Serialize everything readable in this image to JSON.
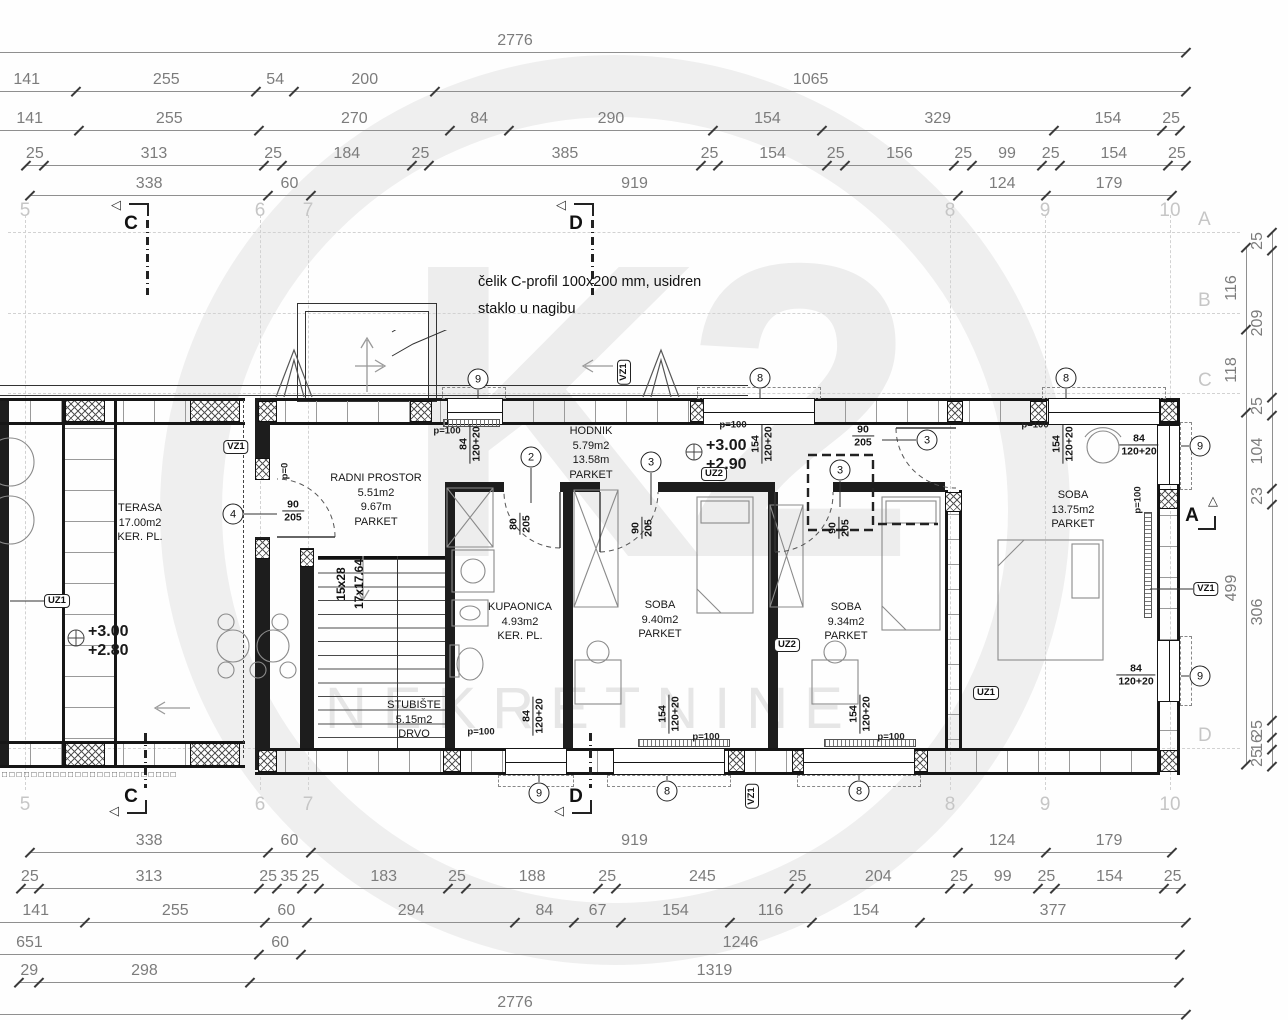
{
  "watermark": {
    "brand": "K2",
    "text": "NEKRETNINE"
  },
  "annotations": {
    "note1": "čelik C-profil 100x200 mm, usidren",
    "note2": "staklo u nagibu"
  },
  "stairs": {
    "label1": "15x28",
    "label2": "17x17.64"
  },
  "levels": [
    {
      "lines": [
        "+3.00",
        "+2.90"
      ]
    },
    {
      "lines": [
        "+3.00",
        "+2.80"
      ]
    }
  ],
  "rooms": [
    {
      "lines": [
        "TERASA",
        "17.00m2",
        "KER. PL."
      ],
      "x": 140,
      "y": 523
    },
    {
      "lines": [
        "RADNI PROSTOR",
        "5.51m2",
        "9.67m",
        "PARKET"
      ],
      "x": 376,
      "y": 500
    },
    {
      "lines": [
        "HODNIK",
        "5.79m2",
        "13.58m",
        "PARKET"
      ],
      "x": 591,
      "y": 453
    },
    {
      "lines": [
        "KUPAONICA",
        "4.93m2",
        "KER. PL."
      ],
      "x": 520,
      "y": 622
    },
    {
      "lines": [
        "SOBA",
        "9.40m2",
        "PARKET"
      ],
      "x": 660,
      "y": 620
    },
    {
      "lines": [
        "SOBA",
        "9.34m2",
        "PARKET"
      ],
      "x": 846,
      "y": 622
    },
    {
      "lines": [
        "SOBA",
        "13.75m2",
        "PARKET"
      ],
      "x": 1073,
      "y": 510
    },
    {
      "lines": [
        "STUBIŠTE",
        "5.15m2",
        "DRVO"
      ],
      "x": 414,
      "y": 720
    }
  ],
  "grid": {
    "cols": [
      {
        "n": "5",
        "x": 25
      },
      {
        "n": "6",
        "x": 260
      },
      {
        "n": "7",
        "x": 308
      },
      {
        "n": "8",
        "x": 950
      },
      {
        "n": "9",
        "x": 1045
      },
      {
        "n": "10",
        "x": 1170
      }
    ],
    "rows": [
      {
        "n": "A",
        "y": 232
      },
      {
        "n": "B",
        "y": 313
      },
      {
        "n": "C",
        "y": 393
      },
      {
        "n": "D",
        "y": 748
      }
    ]
  },
  "sections": {
    "top": [
      {
        "n": "C",
        "x": 133
      },
      {
        "n": "D",
        "x": 578
      }
    ],
    "bottom": [
      {
        "n": "C",
        "x": 133
      },
      {
        "n": "D",
        "x": 578
      }
    ],
    "right": [
      {
        "n": "A",
        "y": 517
      }
    ]
  },
  "tags": {
    "circles": [
      {
        "n": "9",
        "x": 478,
        "y": 379
      },
      {
        "n": "8",
        "x": 760,
        "y": 378
      },
      {
        "n": "8",
        "x": 1066,
        "y": 378
      },
      {
        "n": "2",
        "x": 531,
        "y": 457
      },
      {
        "n": "3",
        "x": 651,
        "y": 462
      },
      {
        "n": "3",
        "x": 840,
        "y": 470
      },
      {
        "n": "3",
        "x": 927,
        "y": 440
      },
      {
        "n": "4",
        "x": 233,
        "y": 514
      },
      {
        "n": "9",
        "x": 1200,
        "y": 446
      },
      {
        "n": "9",
        "x": 1200,
        "y": 676
      },
      {
        "n": "9",
        "x": 539,
        "y": 793
      },
      {
        "n": "8",
        "x": 667,
        "y": 791
      },
      {
        "n": "8",
        "x": 859,
        "y": 791
      }
    ],
    "boxes": [
      {
        "t": "VZ1",
        "x": 624,
        "y": 372,
        "rot": 1
      },
      {
        "t": "VZ1",
        "x": 236,
        "y": 447,
        "rot": 0
      },
      {
        "t": "VZ1",
        "x": 752,
        "y": 796,
        "rot": 1
      },
      {
        "t": "VZ1",
        "x": 1206,
        "y": 589,
        "rot": 0
      },
      {
        "t": "UZ1",
        "x": 57,
        "y": 601,
        "rot": 0
      },
      {
        "t": "UZ1",
        "x": 986,
        "y": 693,
        "rot": 0
      },
      {
        "t": "UZ2",
        "x": 714,
        "y": 474,
        "rot": 0
      },
      {
        "t": "UZ2",
        "x": 787,
        "y": 645,
        "rot": 0
      }
    ]
  },
  "fractions": [
    {
      "a": "90",
      "b": "205",
      "x": 293,
      "y": 511,
      "rot": 0
    },
    {
      "a": "80",
      "b": "205",
      "x": 520,
      "y": 524,
      "rot": 1
    },
    {
      "a": "90",
      "b": "205",
      "x": 642,
      "y": 528,
      "rot": 1
    },
    {
      "a": "90",
      "b": "205",
      "x": 839,
      "y": 528,
      "rot": 1
    },
    {
      "a": "90",
      "b": "205",
      "x": 863,
      "y": 436,
      "rot": 0
    },
    {
      "a": "84",
      "b": "120+20",
      "x": 470,
      "y": 444,
      "rot": 1
    },
    {
      "a": "154",
      "b": "120+20",
      "x": 762,
      "y": 444,
      "rot": 1
    },
    {
      "a": "154",
      "b": "120+20",
      "x": 1063,
      "y": 444,
      "rot": 1
    },
    {
      "a": "84",
      "b": "120+20",
      "x": 1139,
      "y": 445,
      "rot": 0
    },
    {
      "a": "84",
      "b": "120+20",
      "x": 1136,
      "y": 675,
      "rot": 0
    },
    {
      "a": "84",
      "b": "120+20",
      "x": 533,
      "y": 716,
      "rot": 1
    },
    {
      "a": "154",
      "b": "120+20",
      "x": 669,
      "y": 714,
      "rot": 1
    },
    {
      "a": "154",
      "b": "120+20",
      "x": 860,
      "y": 714,
      "rot": 1
    }
  ],
  "small_labels": [
    {
      "t": "p=100",
      "x": 447,
      "y": 431,
      "rot": 0
    },
    {
      "t": "p=100",
      "x": 733,
      "y": 425,
      "rot": 0
    },
    {
      "t": "p=100",
      "x": 1035,
      "y": 425,
      "rot": 0
    },
    {
      "t": "p=100",
      "x": 481,
      "y": 732,
      "rot": 0
    },
    {
      "t": "p=100",
      "x": 706,
      "y": 737,
      "rot": 0
    },
    {
      "t": "p=100",
      "x": 891,
      "y": 737,
      "rot": 0
    },
    {
      "t": "p=100",
      "x": 1138,
      "y": 500,
      "rot": 1
    },
    {
      "t": "p=0",
      "x": 285,
      "y": 471,
      "rot": 1
    }
  ],
  "dims": {
    "scale": 0.705,
    "top": [
      {
        "y": 52,
        "start": -771,
        "values": [
          2776
        ],
        "lx": 515
      },
      {
        "y": 91,
        "start": -23,
        "values": [
          141,
          255,
          54,
          200,
          1065
        ]
      },
      {
        "y": 130,
        "start": -20,
        "values": [
          141,
          255,
          270,
          84,
          290,
          154,
          329,
          154,
          25
        ]
      },
      {
        "y": 165,
        "start": 26,
        "values": [
          25,
          313,
          25,
          184,
          25,
          385,
          25,
          154,
          25,
          156,
          25,
          99,
          25,
          154,
          25
        ]
      },
      {
        "y": 195,
        "start": 30,
        "values": [
          338,
          60,
          919,
          124,
          179
        ]
      }
    ],
    "bottom": [
      {
        "y": 852,
        "start": 30,
        "values": [
          338,
          60,
          919,
          124,
          179
        ]
      },
      {
        "y": 888,
        "start": 21,
        "values": [
          25,
          313,
          25,
          35,
          25,
          183,
          25,
          188,
          25,
          245,
          25,
          204,
          25,
          99,
          25,
          154,
          25
        ]
      },
      {
        "y": 922,
        "start": -14,
        "values": [
          141,
          255,
          60,
          294,
          84,
          67,
          154,
          116,
          154,
          377
        ]
      },
      {
        "y": 954,
        "start": -200,
        "values": [
          651,
          60,
          1246
        ]
      },
      {
        "y": 982,
        "start": 19,
        "values": [
          29,
          298,
          1319
        ]
      },
      {
        "y": 1014,
        "start": -771,
        "values": [
          2776
        ],
        "lx": 515
      }
    ],
    "right": [
      {
        "x": 1246,
        "start": 247,
        "values": [
          116,
          118,
          499
        ]
      },
      {
        "x": 1272,
        "start": 232,
        "values": [
          25,
          209,
          25,
          104,
          23,
          306,
          25,
          16,
          25
        ]
      }
    ]
  }
}
